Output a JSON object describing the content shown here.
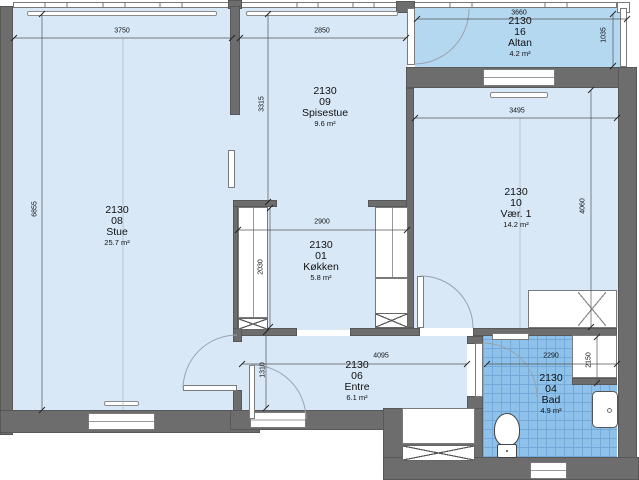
{
  "rooms": [
    {
      "code": "2130",
      "number": "08",
      "name": "Stue",
      "area": "25.7 m²"
    },
    {
      "code": "2130",
      "number": "09",
      "name": "Spisestue",
      "area": "9.6 m²"
    },
    {
      "code": "2130",
      "number": "01",
      "name": "Køkken",
      "area": "5.8 m²"
    },
    {
      "code": "2130",
      "number": "16",
      "name": "Altan",
      "area": "4.2 m²"
    },
    {
      "code": "2130",
      "number": "10",
      "name": "Vær. 1",
      "area": "14.2 m²"
    },
    {
      "code": "2130",
      "number": "06",
      "name": "Entre",
      "area": "6.1 m²"
    },
    {
      "code": "2130",
      "number": "04",
      "name": "Bad",
      "area": "4.9 m²"
    }
  ],
  "dimensions_mm": {
    "stue_top_width": "3750",
    "spisestue_top_width": "2850",
    "altan_width": "3660",
    "altan_depth": "1035",
    "stue_left_height": "6855",
    "spisestue_height": "3315",
    "kokken_width": "2900",
    "kokken_height": "2030",
    "vaer1_width": "3495",
    "vaer1_height": "4060",
    "entre_width": "4095",
    "entre_depth": "1310",
    "bad_width": "2290",
    "bad_height": "2150"
  },
  "colors": {
    "floor": "#d9e8f7",
    "balcony_floor": "#b5d8f1",
    "bath_tile": "#8ec2ea",
    "wall": "#6d6d6d"
  }
}
